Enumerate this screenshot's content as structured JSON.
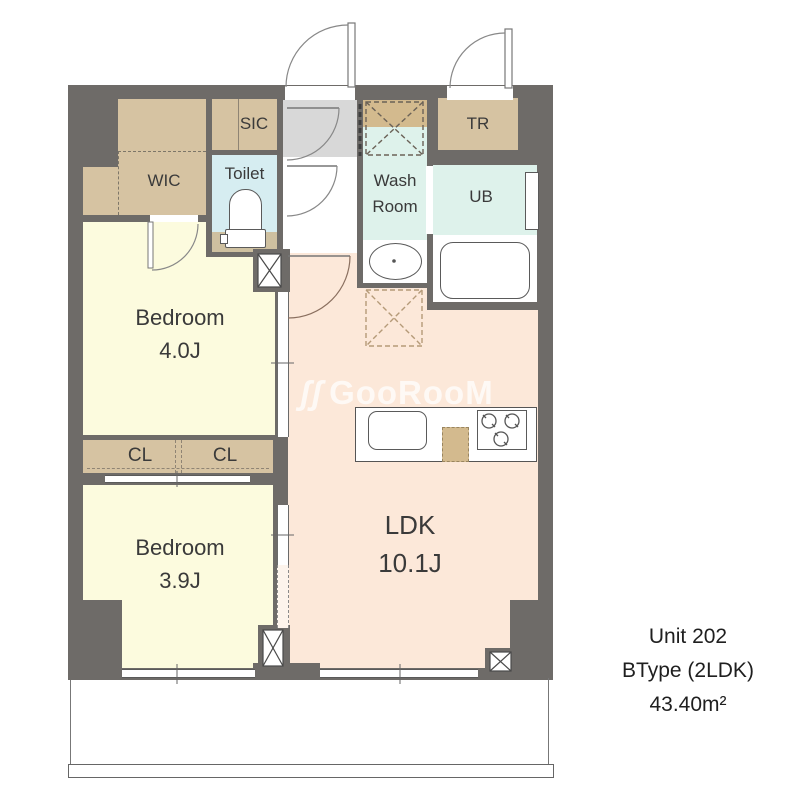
{
  "plan": {
    "rooms": {
      "bedroom1": {
        "name": "Bedroom",
        "area": "4.0J"
      },
      "bedroom2": {
        "name": "Bedroom",
        "area": "3.9J"
      },
      "ldk": {
        "name": "LDK",
        "area": "10.1J"
      },
      "wic": "WIC",
      "sic": "SIC",
      "toilet": "Toilet",
      "washroom": "Wash Room",
      "ub": "UB",
      "tr": "TR",
      "cl1": "CL",
      "cl2": "CL"
    },
    "unit": {
      "line1": "Unit 202",
      "line2": "BType (2LDK)",
      "line3": "43.40m²"
    },
    "watermark": {
      "mark": "ʃʃ",
      "text": "GooRooM"
    },
    "colors": {
      "wall": "#6e6b68",
      "bedroom": "#fcfbde",
      "ldk": "#fce8d9",
      "wet_room": "#def2eb",
      "storage": "#d6c3a2",
      "entry": "#d8d8d8"
    }
  }
}
